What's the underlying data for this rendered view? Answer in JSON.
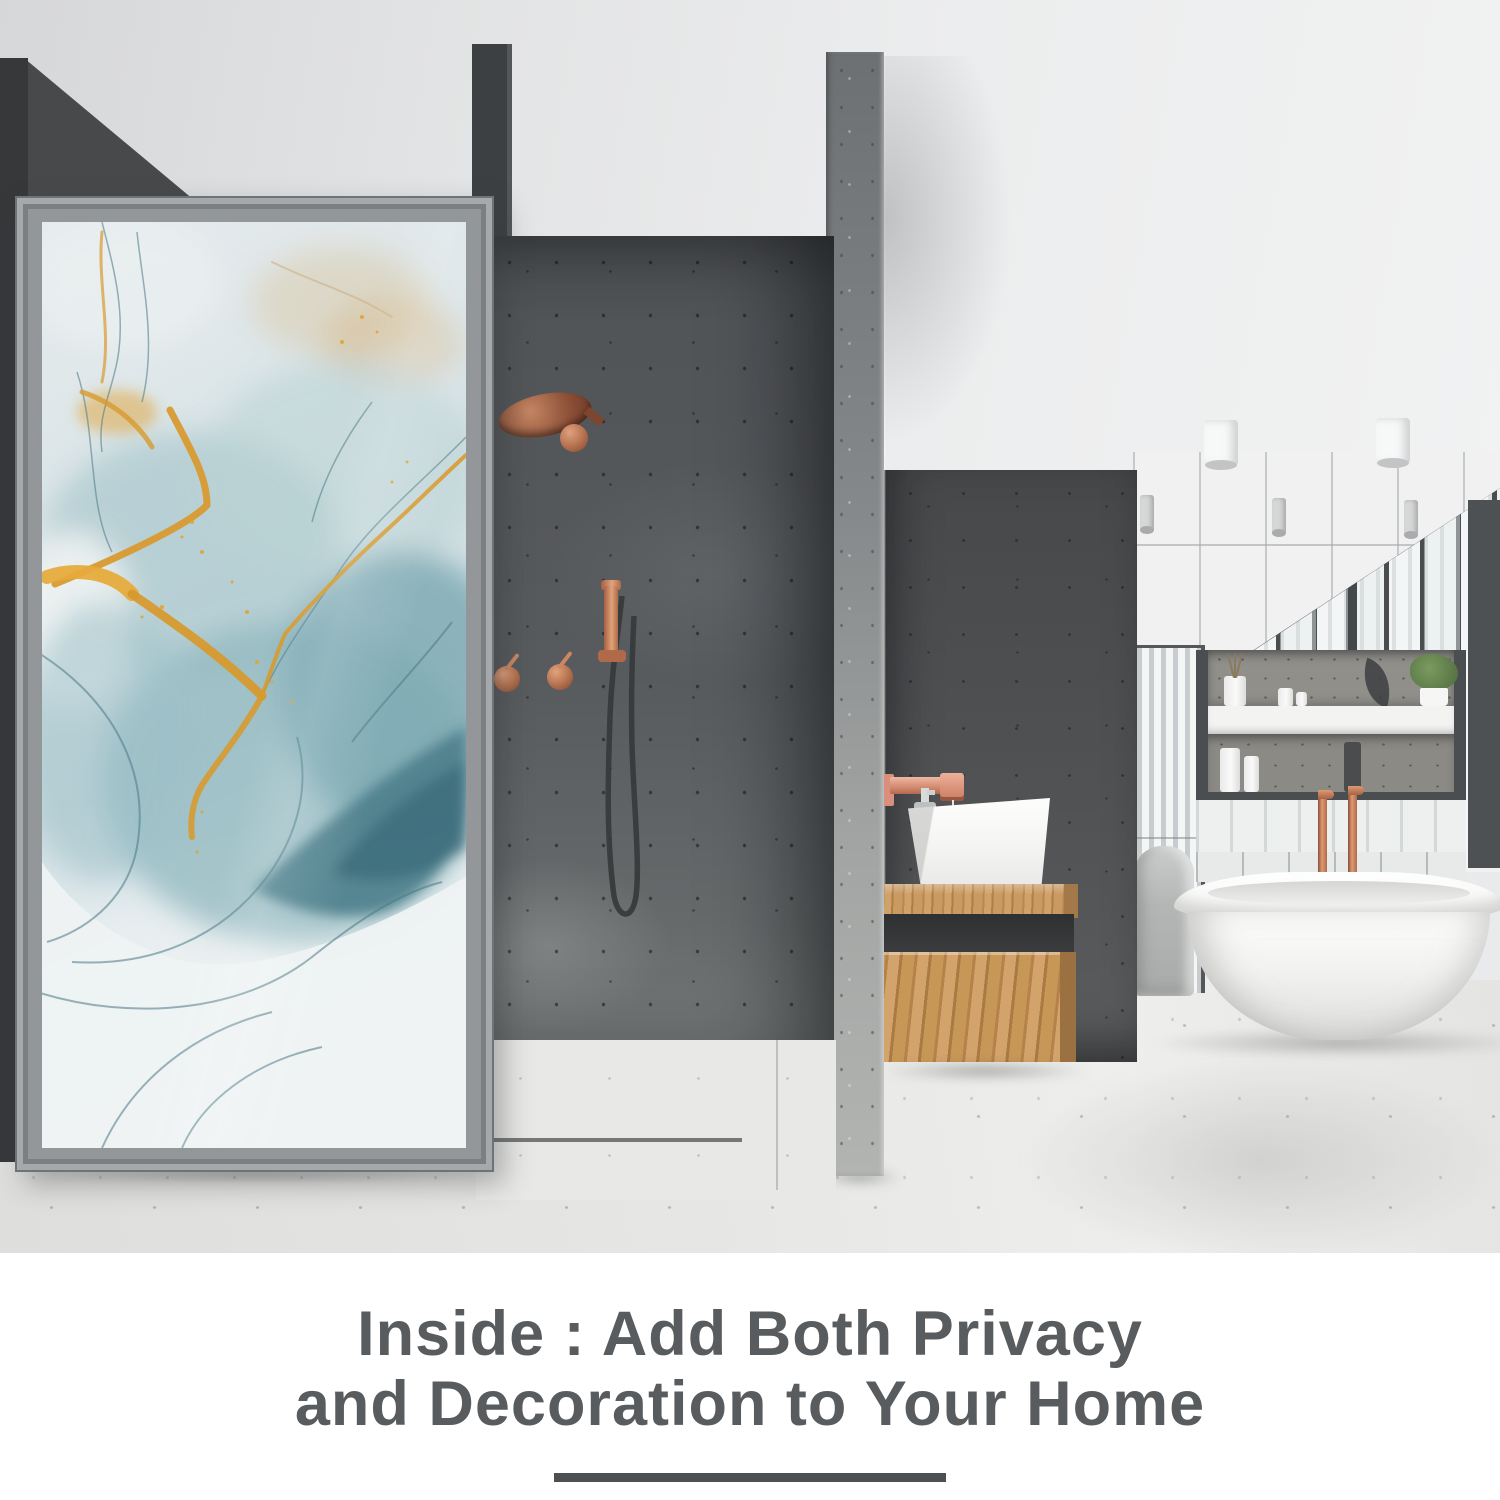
{
  "caption": {
    "line1": "Inside : Add Both Privacy",
    "line2": "and Decoration to Your Home"
  },
  "palette": {
    "caption_text": "#595c5e",
    "underline_bar": "#4d5052",
    "copper_fixture": "#c17a5a",
    "marble_teal": "#7fa9b2",
    "marble_gold": "#dfa437",
    "wood_vanity": "#c8995f",
    "concrete_dark": "#4b4e50",
    "concrete_light": "#a9abaa",
    "floor": "#e3e3e1"
  }
}
